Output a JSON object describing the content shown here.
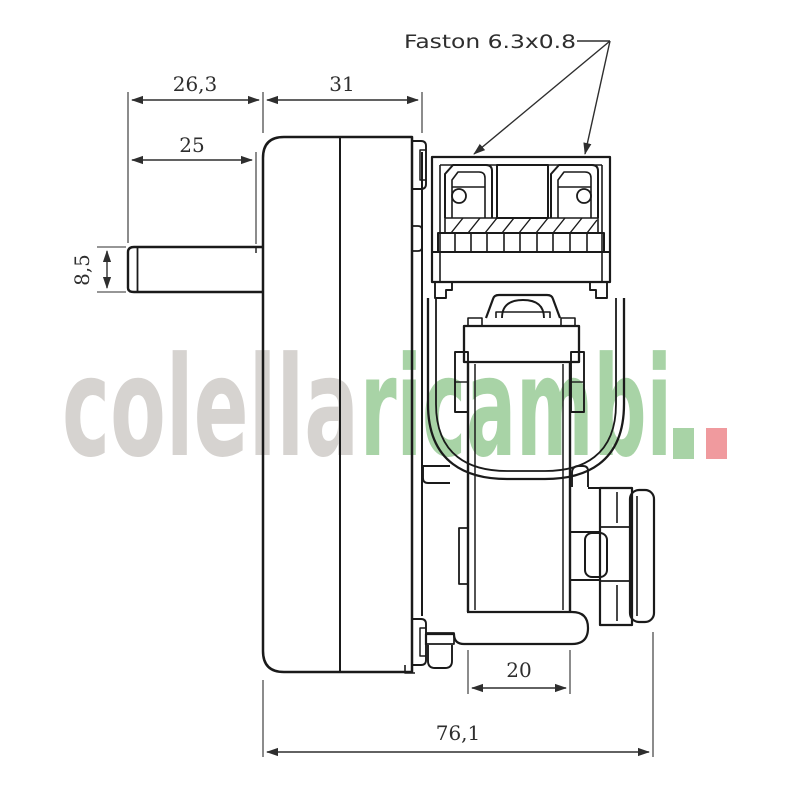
{
  "drawing": {
    "labels": {
      "faston": "Faston 6.3x0.8"
    },
    "dimensions": {
      "shaft_to_body_top": "26,3",
      "gearbox_width": "31",
      "shaft_length": "25",
      "shaft_diameter": "8,5",
      "motor_width": "20",
      "overall_width": "76,1"
    }
  },
  "watermark": {
    "part_gray": "colella",
    "part_green": "ricambi"
  },
  "colors": {
    "background": "#ffffff",
    "line": "#1a1a1a",
    "dimension": "#2e2e2e",
    "watermark_gray": "#d6d3d0",
    "watermark_green": "#a8d3a6",
    "watermark_red": "#f09a9e"
  }
}
